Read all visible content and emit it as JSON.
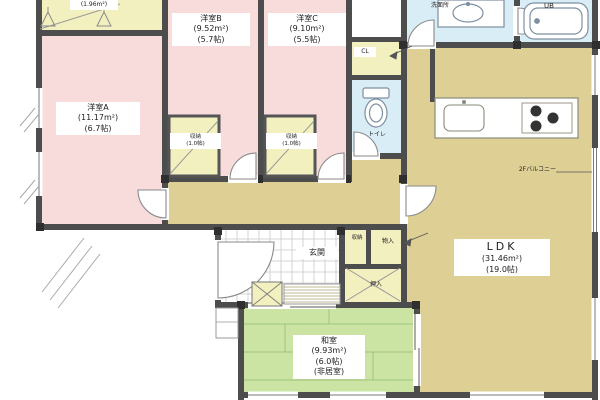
{
  "rooms": {
    "western_a": {
      "name": "洋室A",
      "area": "(11.17m²)",
      "size": "(6.7帖)"
    },
    "western_b": {
      "name": "洋室B",
      "area": "(9.52m²)",
      "size": "(5.7帖)"
    },
    "western_c": {
      "name": "洋室C",
      "area": "(9.10m²)",
      "size": "(5.5帖)"
    },
    "ldk": {
      "name": "LDK",
      "area": "(31.46m²)",
      "size": "(19.0帖)"
    },
    "japanese": {
      "name": "和室",
      "area": "(9.93m²)",
      "size": "(6.0帖)",
      "note": "(非居室)"
    },
    "entrance": {
      "name": "玄関"
    },
    "toilet": {
      "name": "トイレ"
    },
    "washroom": {
      "name": "洗面所"
    },
    "bath": {
      "name": "UB"
    },
    "closet_b": {
      "name": "収納",
      "size": "(1.0帖)"
    },
    "closet_c": {
      "name": "収納",
      "size": "(1.0帖)"
    },
    "closet_hall": {
      "name": "CL"
    },
    "storage_small": {
      "name": "収納"
    },
    "storage_large": {
      "name": "物入"
    },
    "futon_closet": {
      "name": "押入"
    },
    "wic": {
      "area": "(1.96m²)"
    }
  },
  "annotations": {
    "balcony": "2Fバルコニー"
  },
  "colors": {
    "wall": "#4d4d4d",
    "western_room": "#f8dcdc",
    "closet": "#f3f0c0",
    "ldk": "#ded094",
    "japanese_room": "#cbe4a3",
    "wet_area": "#d9edf6"
  }
}
